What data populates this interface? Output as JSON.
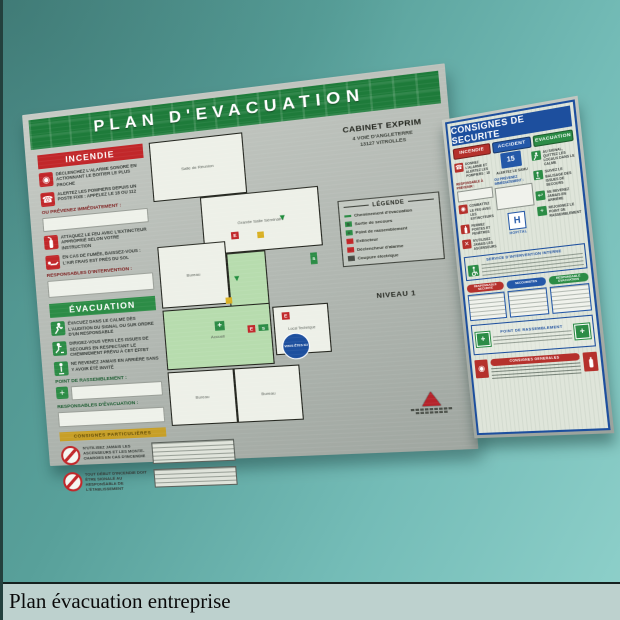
{
  "caption": "Plan évacuation entreprise",
  "colors": {
    "wall_top": "#4c8d88",
    "wall_bottom": "#8ed0ca",
    "board_green": "#1e7b3a",
    "board_red": "#c1272a",
    "board_blue": "#1d4f9e",
    "caption_bg": "#bdd1ce"
  },
  "evacuation_board": {
    "title": "PLAN  D'EVACUATION",
    "company_name": "CABINET EXPRIM",
    "company_address1": "4 VOIE D'ANGLETERRE",
    "company_address2": "13127 VITROLLES",
    "level_label": "NIVEAU 1",
    "incendie": {
      "header": "INCENDIE",
      "item1": "DÉCLENCHEZ L'ALARME SONORE EN ACTIONNANT LE BOITIER LE PLUS PROCHE",
      "item2": "ALERTEZ LES POMPIERS DEPUIS UN POSTE FIXE : APPELEZ LE 18 ou 112",
      "notify_label": "OU PRÉVENEZ IMMÉDIATEMENT :",
      "item3": "ATTAQUEZ LE FEU AVEC L'EXTINCTEUR APPROPRIÉ SELON VOTRE INSTRUCTION",
      "item4": "EN CAS DE FUMÉE, BAISSEZ-VOUS : L'AIR FRAIS EST PRÈS DU SOL",
      "responsables_label": "RESPONSABLES D'INTERVENTION :"
    },
    "evacuation": {
      "header": "ÉVACUATION",
      "item1": "ÉVACUEZ DANS LE CALME DÈS L'AUDITION DU SIGNAL OU SUR ORDRE D'UN RESPONSABLE",
      "item2": "DIRIGEZ-VOUS VERS LES ISSUES DE SECOURS EN RESPECTANT LE CHEMINEMENT PRÉVU À CET EFFET",
      "item3": "NE REVENEZ JAMAIS EN ARRIÈRE SANS Y AVOIR ÉTÉ INVITÉ",
      "rassemblement_label": "POINT DE RASSEMBLEMENT :",
      "responsables_label": "RESPONSABLES D'ÉVACUATION :"
    },
    "particulieres_band": "CONSIGNES PARTICULIÈRES",
    "interdiction1": "N'UTILISEZ JAMAIS LES ASCENSEURS ET LES MONTE-CHARGES EN CAS D'INCENDIE",
    "interdiction2": "TOUT DÉBUT D'INCENDIE DOIT ÊTRE SIGNALÉ AU RESPONSABLE DE L'ÉTABLISSEMENT",
    "legend": {
      "title": "LÉGENDE",
      "entries": [
        {
          "icon": "evacuation-path-icon",
          "label": "Cheminement d'évacuation"
        },
        {
          "icon": "emergency-exit-icon",
          "label": "Sortie de secours"
        },
        {
          "icon": "assembly-point-icon",
          "label": "Point de rassemblement"
        },
        {
          "icon": "extinguisher-icon",
          "label": "Extincteur"
        },
        {
          "icon": "alarm-trigger-icon",
          "label": "Déclencheur d'alarme"
        },
        {
          "icon": "power-cutoff-icon",
          "label": "Coupure électrique"
        }
      ]
    },
    "plan": {
      "room1": "Salle de Réunion",
      "room2": "Grande Salle Séminaire",
      "room3": "Bureau",
      "room4": "Accueil",
      "room5": "Local Technique",
      "room6": "Bureau",
      "room7": "Bureau",
      "you_are_here": "VOUS ÊTES ICI"
    }
  },
  "safety_board": {
    "title": "CONSIGNES DE SECURITE",
    "incendie": {
      "header": "INCENDIE",
      "item1": "DONNEZ L'ALARME ET ALERTEZ LES POMPIERS : 18",
      "notify_label": "RESPONSABLE À PRÉVENIR :",
      "item2": "COMBATTEZ LE FEU AVEC LES EXTINCTEURS",
      "item3": "FERMEZ PORTES ET FENÊTRES",
      "item4": "N'UTILISEZ JAMAIS LES ASCENSEURS"
    },
    "accident": {
      "header": "ACCIDENT",
      "samu_number": "15",
      "item1": "ALERTEZ LE SAMU",
      "notify_label": "OU PRÉVENEZ IMMÉDIATEMENT :",
      "hospital_letter": "H",
      "hospital_label": "HOPITAL"
    },
    "evacuation": {
      "header": "EVACUATION",
      "item1": "AU SIGNAL, QUITTEZ LES LOCAUX DANS LE CALME",
      "item2": "SUIVEZ LE BALISAGE DES ISSUES DE SECOURS",
      "item3": "NE REVENEZ JAMAIS EN ARRIÈRE",
      "item4": "REJOIGNEZ LE POINT DE RASSEMBLEMENT"
    },
    "service_title": "SERVICE D'INTERVENTION INTERNE",
    "pill1": "RESPONSABLE SECURITE",
    "pill2": "SECOURISTES",
    "pill3": "RESPONSABLE EVACUATION",
    "rassemblement_title": "POINT DE RASSEMBLEMENT",
    "general_title": "CONSIGNES GENERALES"
  }
}
